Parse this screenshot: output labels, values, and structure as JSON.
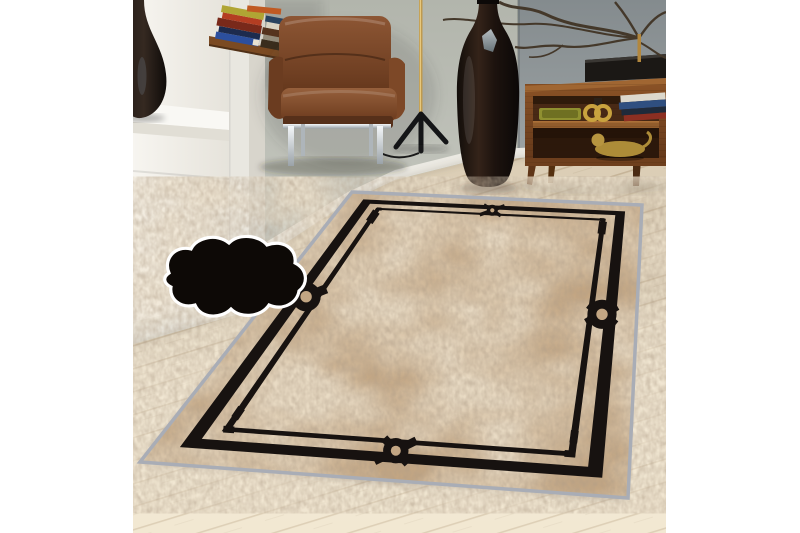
{
  "scene": {
    "subject": "beige bordered area rug staged in a living room",
    "objects": [
      "window-ledge-teardrop-vase",
      "corner-desk-book-stacks",
      "brown-leather-armchair",
      "tripod-floor-lamp",
      "tall-dark-floor-vase",
      "wooden-sideboard-with-decor",
      "branch-sculpture",
      "area-rug",
      "rug-texture-cloud-inset"
    ]
  },
  "palette": {
    "canvas": "#ffffff",
    "wall_left": "#efede6",
    "wall_mid": "#b9bcb4",
    "wall_right": "#8a9093",
    "baseboard": "#ebe9e2",
    "floor": "#efe5d0",
    "floor_line": "#a58c69",
    "leather": "#7c4a2b",
    "leather_dark": "#562e16",
    "chrome": "#dfe4e8",
    "brass": "#bf9a4e",
    "wood": "#80491f",
    "vase": "#1c1310",
    "black_accent": "#16110d",
    "gold_decor": "#c8a23e",
    "olive_tray": "#8f9030",
    "rug_field": "#c3a683",
    "rug_light": "#dac5a1",
    "rug_dark": "#a08463",
    "rug_binding": "#a9adb6",
    "rug_border": "#171210",
    "inset_pile": "#c9b08a",
    "inset_serge": "#e4e7ec",
    "inset_backing": "#3a2812",
    "inset_outline": "#ffffff"
  },
  "rug": {
    "quad": {
      "A": [
        219,
        192
      ],
      "B": [
        509,
        205
      ],
      "C": [
        495,
        498
      ],
      "D": [
        7,
        462
      ]
    },
    "border": {
      "outer": [
        0.056,
        0.088
      ],
      "inner": [
        0.118,
        0.134
      ],
      "aspect": 0.7
    },
    "perspective": 1.63,
    "motif_positions": [
      0.5
    ],
    "bead_positions": [
      0.13,
      0.87
    ]
  }
}
